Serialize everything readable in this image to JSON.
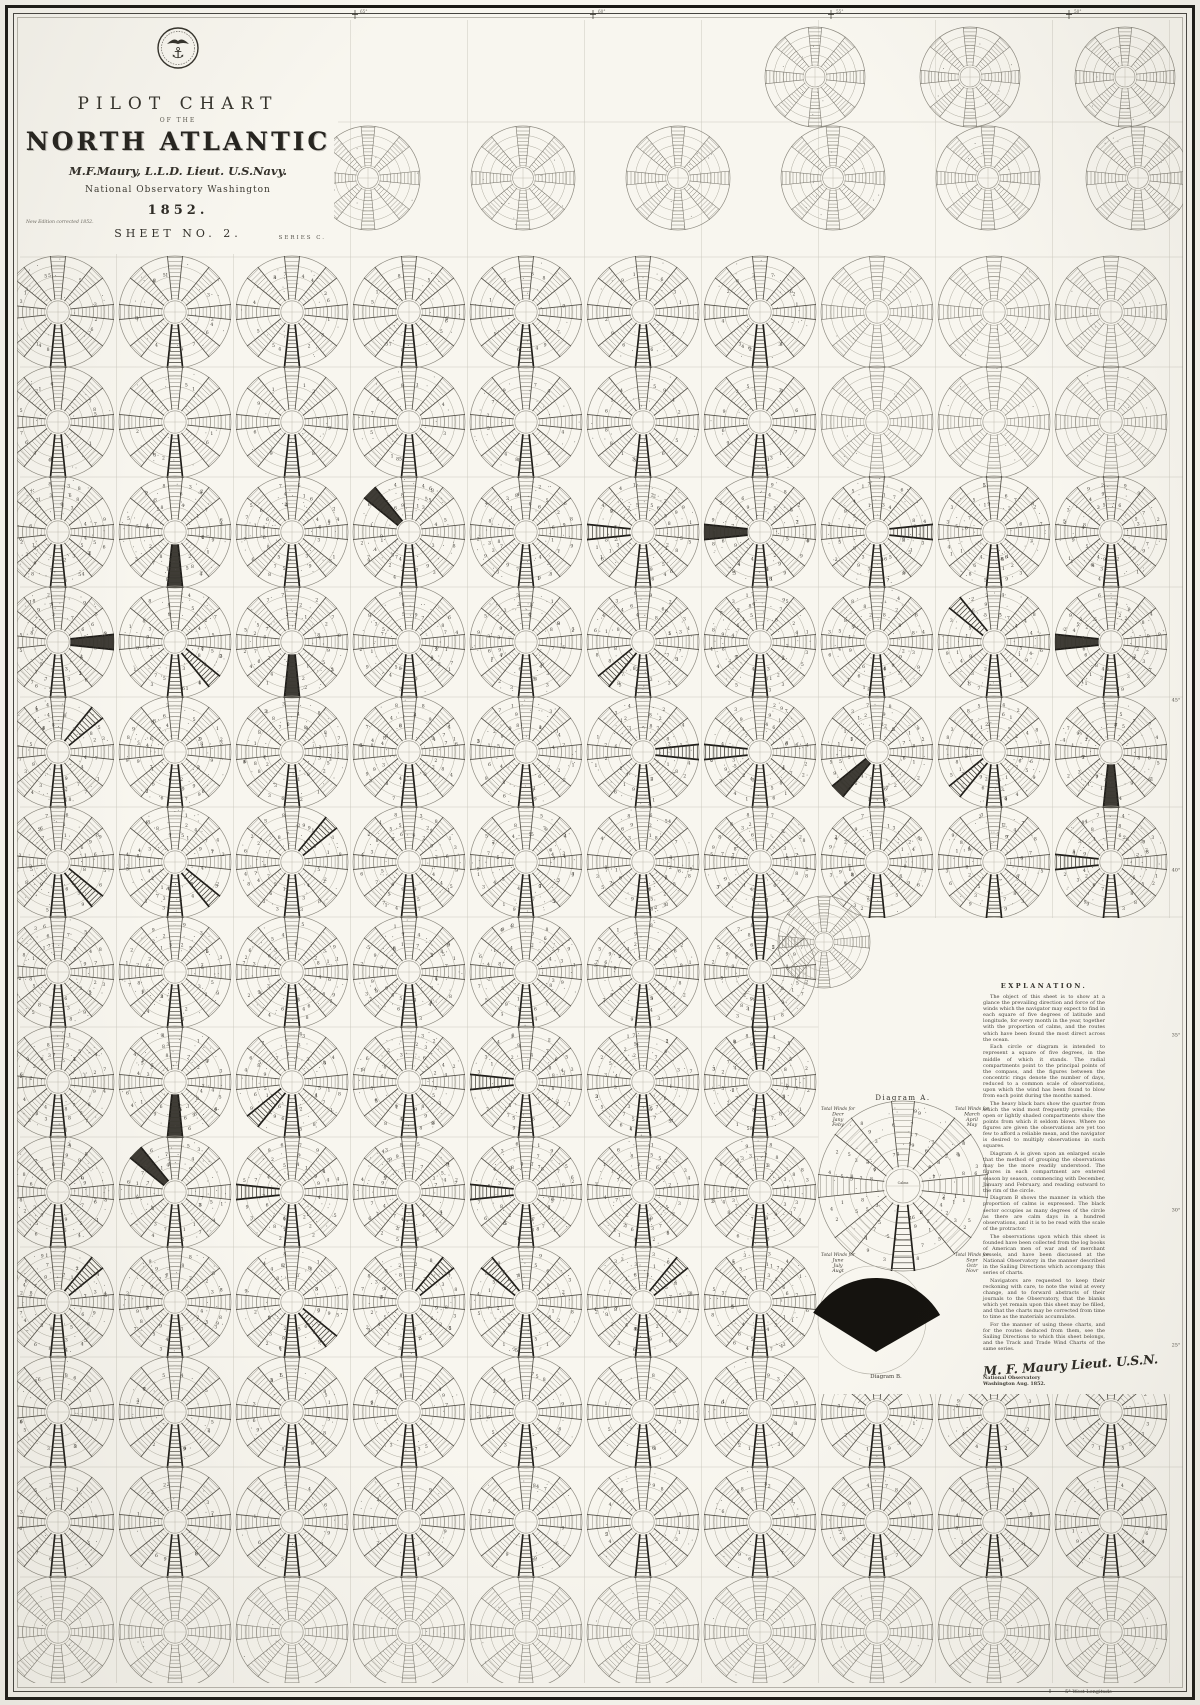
{
  "title_block": {
    "line1": "PILOT CHART",
    "line2": "OF THE",
    "line3": "NORTH ATLANTIC",
    "author": "M.F.Maury, L.L.D. Lieut. U.S.Navy.",
    "observatory": "National Observatory Washington",
    "year": "1852.",
    "edition_note": "New Edition corrected 1852.",
    "sheet": "SHEET NO. 2.",
    "series": "SERIES C."
  },
  "explanation": {
    "heading": "EXPLANATION.",
    "paragraphs": [
      "The object of this sheet is to show at a glance the prevailing direction and force of the winds which the navigator may expect to find in each square of five degrees of latitude and longitude, for every month in the year, together with the proportion of calms, and the routes which have been found the most direct across the ocean.",
      "Each circle or diagram is intended to represent a square of five degrees, in the middle of which it stands. The radial compartments point to the principal points of the compass, and the figures between the concentric rings denote the number of days, reduced to a common scale of observations, upon which the wind has been found to blow from each point during the months named.",
      "The heavy black bars show the quarter from which the wind most frequently prevails; the open or lightly shaded compartments show the points from which it seldom blows. Where no figures are given the observations are yet too few to afford a reliable mean, and the navigator is desired to multiply observations in such squares.",
      "Diagram A is given upon an enlarged scale that the method of grouping the observations may be the more readily understood. The figures in each compartment are entered season by season, commencing with December, January and February, and reading outward to the rim of the circle.",
      "Diagram B shows the manner in which the proportion of calms is expressed. The black sector occupies as many degrees of the circle as there are calm days in a hundred observations, and it is to be read with the scale of the protractor.",
      "The observations upon which this sheet is founded have been collected from the log books of American men of war and of merchant vessels, and have been discussed at the National Observatory in the manner described in the Sailing Directions which accompany this series of charts.",
      "Navigators are requested to keep their reckoning with care, to note the wind at every change, and to forward abstracts of their journals to the Observatory, that the blanks which yet remain upon this sheet may be filled, and that the charts may be corrected from time to time as the materials accumulate.",
      "For the manner of using these charts, and for the routes deduced from them, see the Sailing Directions to which this sheet belongs, and the Track and Trade Wind Charts of the same series."
    ],
    "signature": "M. F. Maury Lieut. U.S.N.",
    "imprint_line1": "National Observatory",
    "imprint_line2": "Washington Aug. 1852."
  },
  "diagram_a": {
    "title": "Diagram A.",
    "center_label": "Calms",
    "corner_labels": [
      {
        "pos": "top-left",
        "lines": [
          "Total Winds for",
          "Decr",
          "Jany",
          "Feby"
        ]
      },
      {
        "pos": "top-right",
        "lines": [
          "Total Winds for",
          "March",
          "April",
          "May"
        ]
      },
      {
        "pos": "bottom-left",
        "lines": [
          "Total Winds for",
          "June",
          "July",
          "Augt"
        ]
      },
      {
        "pos": "bottom-right",
        "lines": [
          "Total Winds for",
          "Sepr",
          "Octr",
          "Novr"
        ]
      }
    ]
  },
  "diagram_b": {
    "title": "Diagram B."
  },
  "border": {
    "bottom_label": "5° West Longitude",
    "top_ticks": [
      "65°",
      "60°",
      "55°",
      "50°"
    ],
    "right_latitudes": [
      "45°",
      "40°",
      "35°",
      "30°",
      "25°"
    ]
  },
  "rose_grid": {
    "bands": [
      {
        "y": 77,
        "r": 50,
        "xs": [
          815,
          970,
          1125
        ],
        "density": "light"
      },
      {
        "y": 178,
        "r": 52,
        "xs": [
          368,
          523,
          678,
          833,
          988,
          1138
        ],
        "density": "light"
      }
    ],
    "main": {
      "x0": 58,
      "col_step": 117,
      "cols": 10,
      "y0": 312,
      "row_step": 110,
      "rows": 13,
      "radius": 56
    },
    "density_by_row": [
      "medium",
      "medium",
      "dense",
      "dense",
      "dense",
      "dense",
      "dense",
      "dense",
      "dense",
      "dense",
      "medium",
      "medium",
      "light"
    ],
    "blank_cells": [
      [
        6,
        7
      ],
      [
        6,
        8
      ],
      [
        6,
        9
      ],
      [
        7,
        7
      ],
      [
        7,
        8
      ],
      [
        7,
        9
      ],
      [
        8,
        7
      ],
      [
        8,
        8
      ],
      [
        8,
        9
      ],
      [
        9,
        7
      ],
      [
        9,
        8
      ],
      [
        9,
        9
      ]
    ],
    "panel_rose": {
      "x": 824,
      "y": 942,
      "r": 46
    },
    "diagram_a_pos": {
      "x": 903,
      "y": 1186,
      "r": 85
    },
    "diagram_b_pos": {
      "x": 872,
      "y": 1320,
      "r": 54
    }
  },
  "colors": {
    "paper": "#f8f6ef",
    "ink": "#26241f",
    "rose_light": "#7b786f",
    "rose_dark": "#514e46",
    "rose_bold": "#1f1d19",
    "ring": "#aeab9f",
    "ring_outer": "#8f8c82",
    "graticule": "#ccc9bf",
    "digit": "#45423b"
  }
}
